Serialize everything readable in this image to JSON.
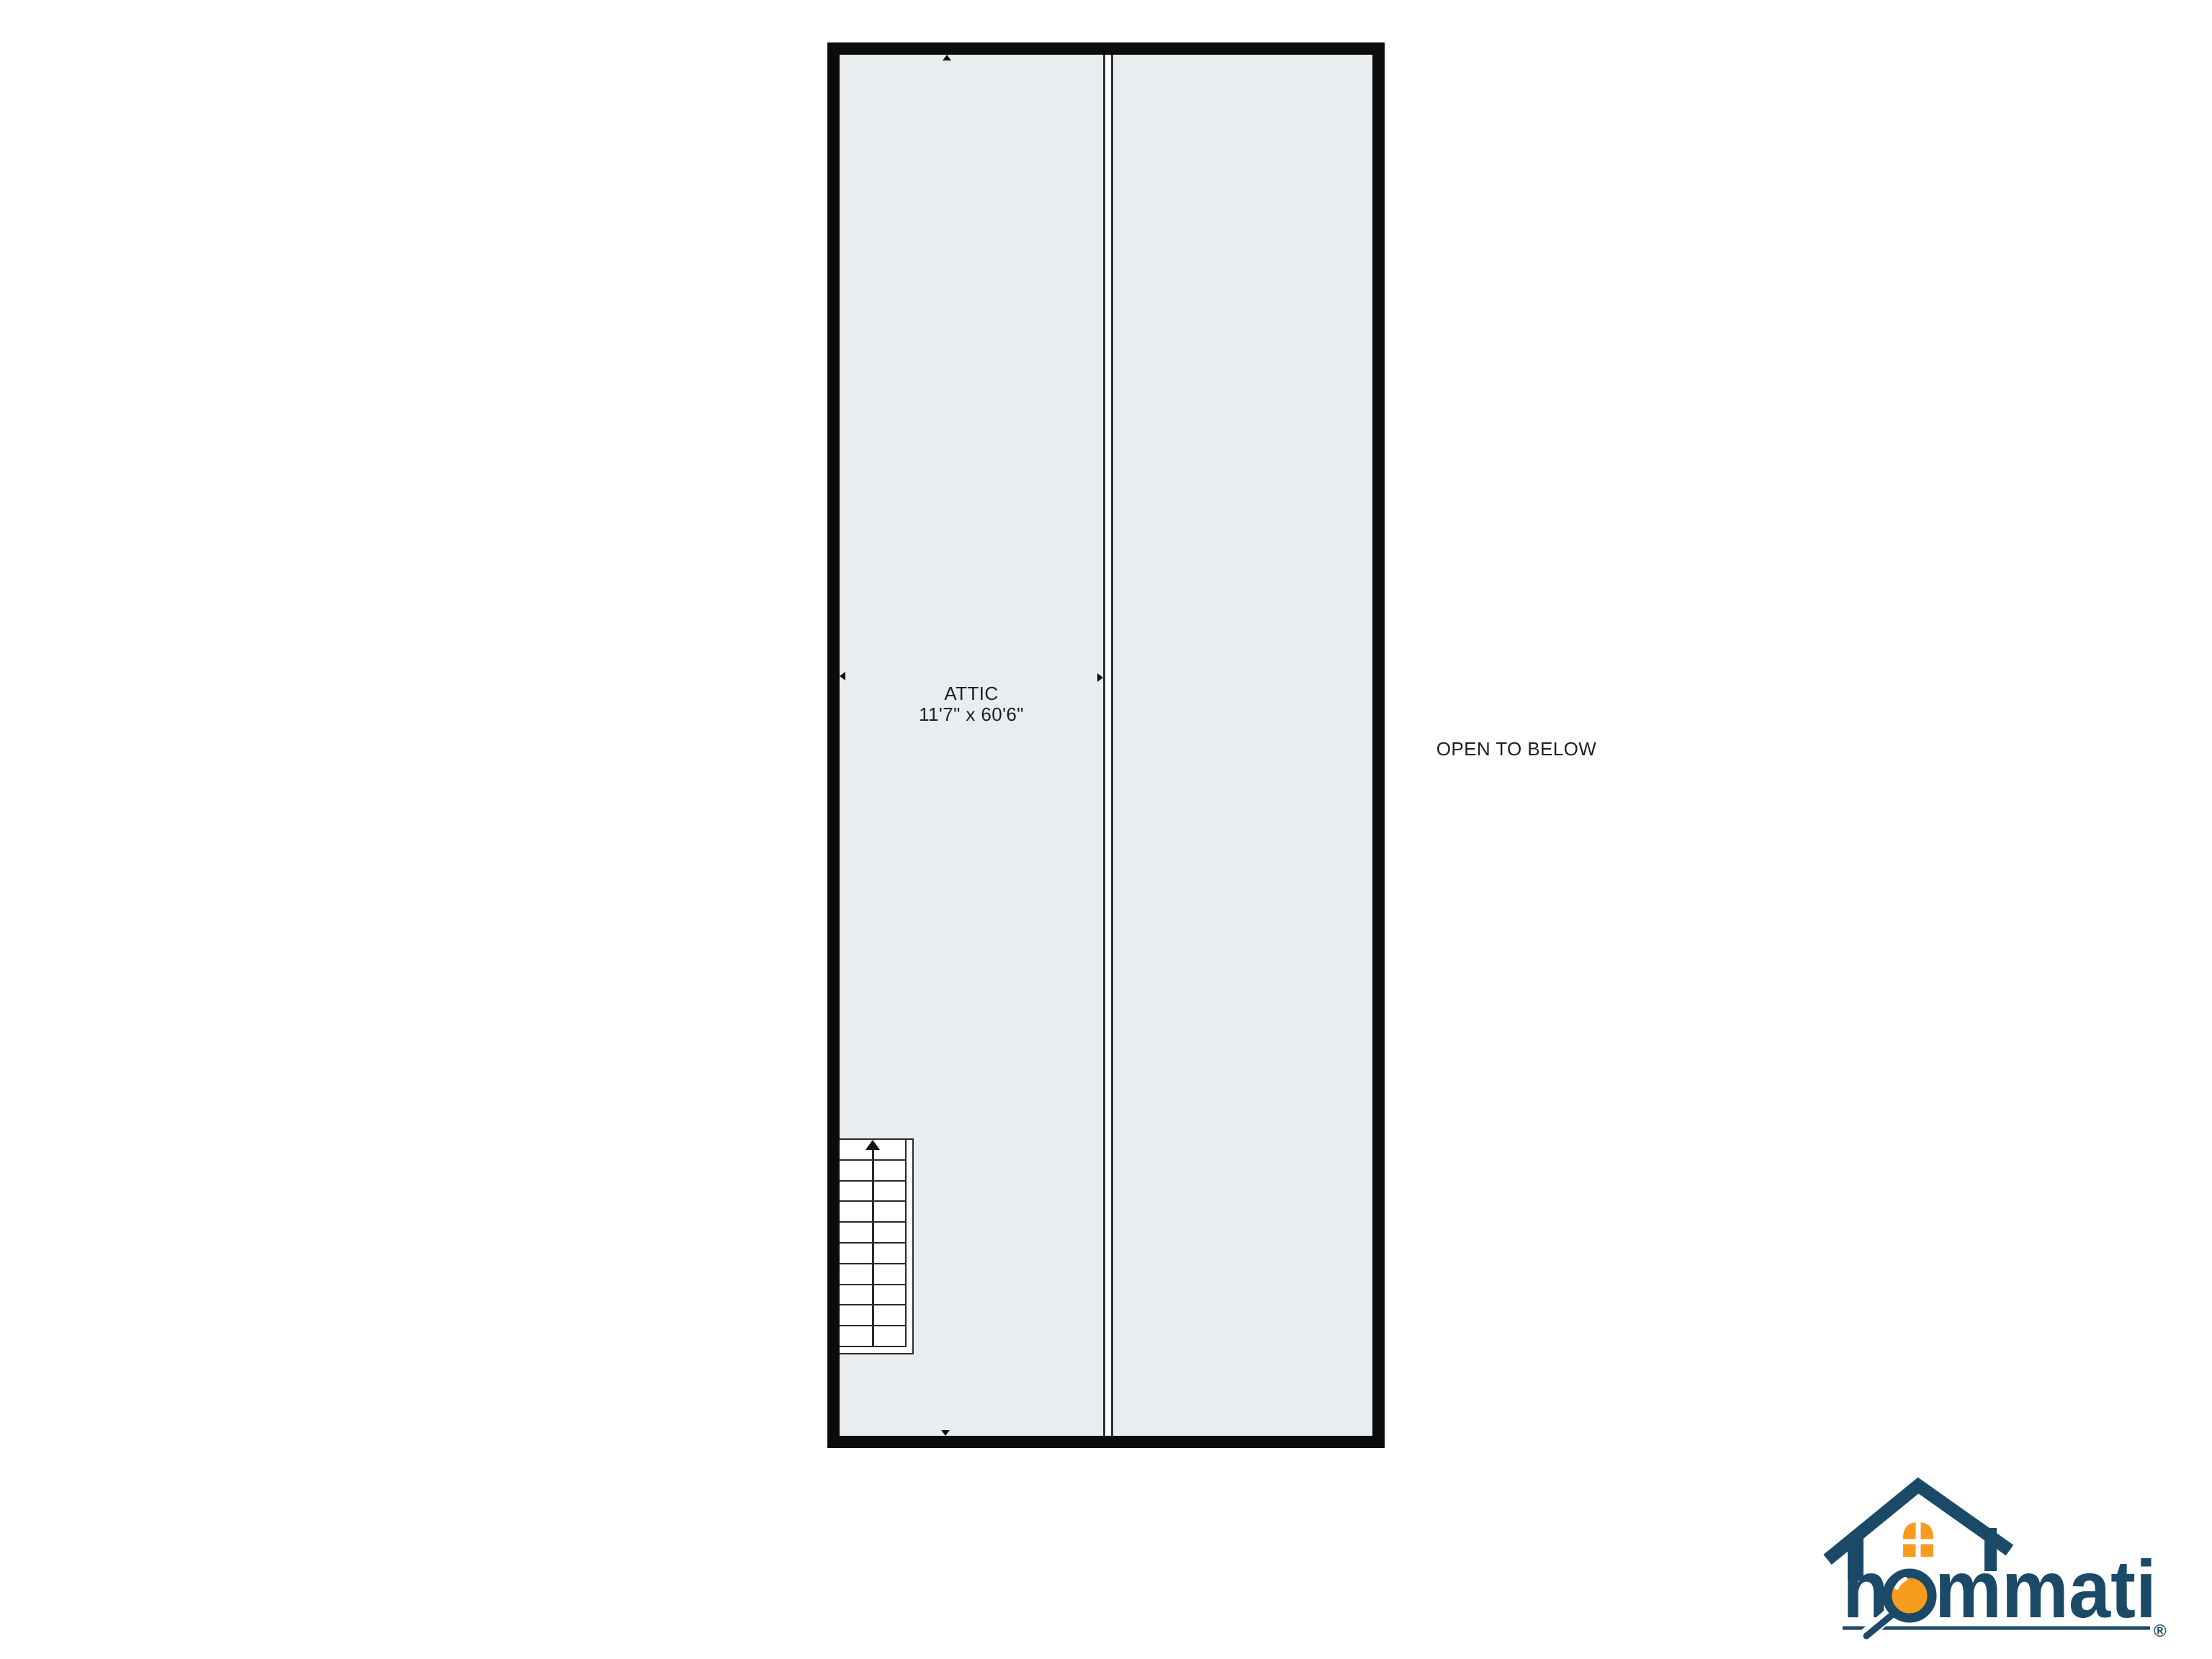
{
  "page": {
    "background": "#ffffff"
  },
  "floorplan": {
    "rooms": {
      "attic": {
        "label": "ATTIC",
        "dimensions": "11'7\" x 60'6\""
      },
      "open_to_below": {
        "label": "OPEN TO BELOW"
      }
    },
    "staircase": {
      "steps": 10,
      "direction": "up"
    },
    "dimension_markers": [
      "up",
      "down",
      "left",
      "right"
    ],
    "colors": {
      "wall": "#0c0c0c",
      "floor": "#e9edf0",
      "line": "#2e3236",
      "stair_line": "#2a2a2a"
    }
  },
  "logo": {
    "brand": "hommati",
    "registered_mark": "®",
    "colors": {
      "navy": "#1b4a68",
      "orange": "#f89c1e"
    }
  }
}
